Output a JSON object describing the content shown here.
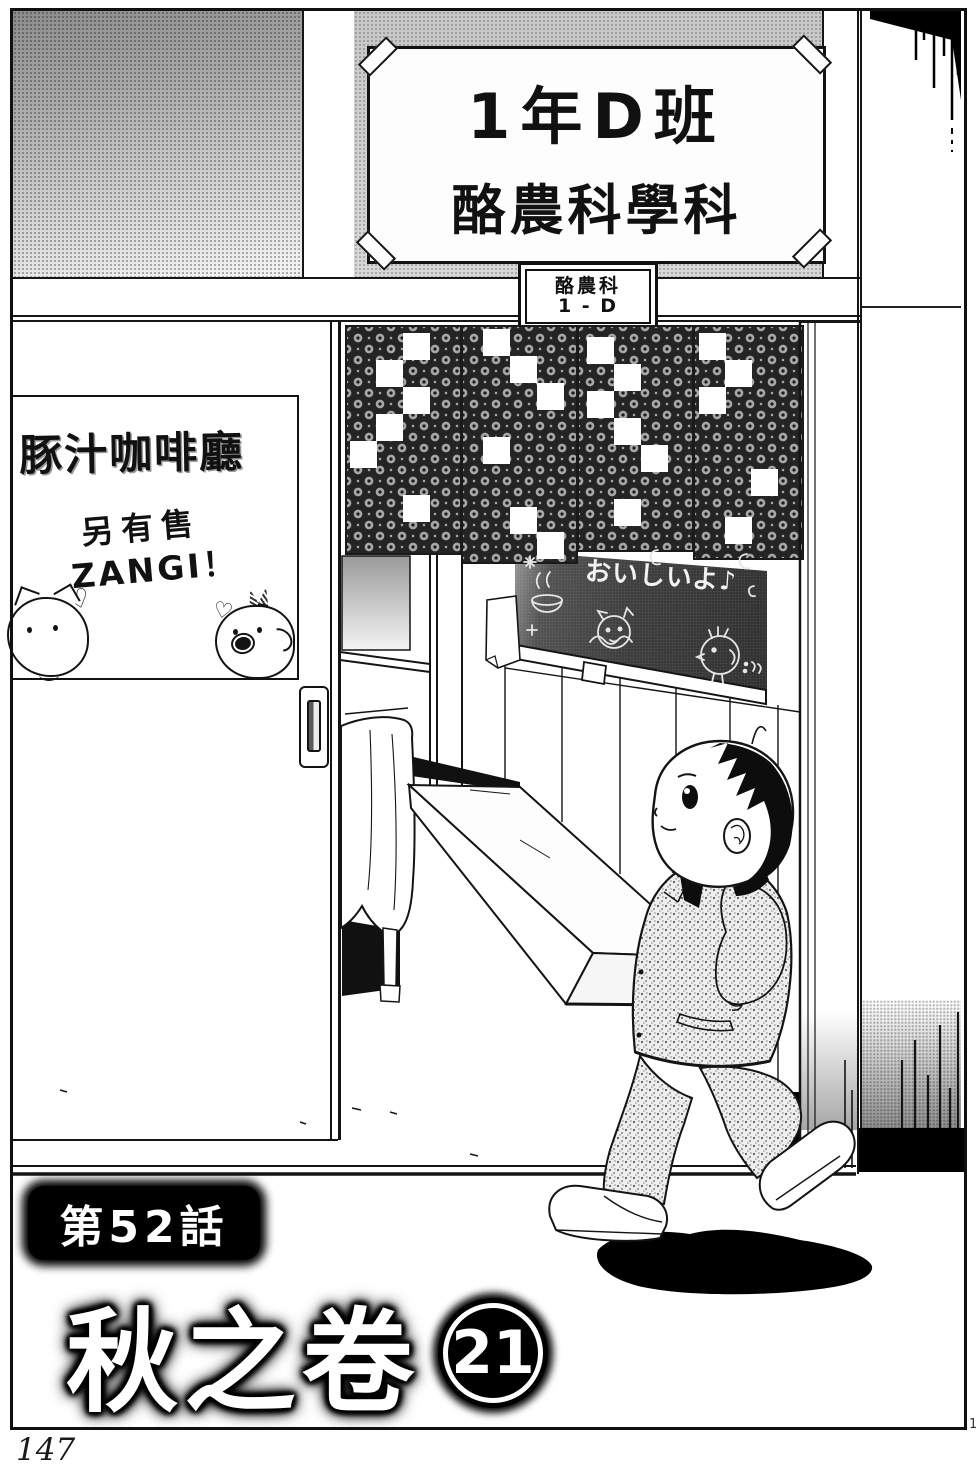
{
  "page": {
    "number": "147",
    "corner_mark": "1"
  },
  "classroom_sign": {
    "line1": "1年D班",
    "line2": "酪農科學科"
  },
  "door_plate": {
    "line1": "酪農科",
    "line2": "1 - D"
  },
  "poster": {
    "title": "豚汁咖啡廳",
    "subtitle": "另有售",
    "subtitle2": "ZANGI！"
  },
  "chalkboard": {
    "message": "おいしいよ♪"
  },
  "title_block": {
    "chapter": "第52話",
    "title": "秋之卷",
    "episode_number": "21"
  },
  "icons": {
    "heart": "♡"
  }
}
